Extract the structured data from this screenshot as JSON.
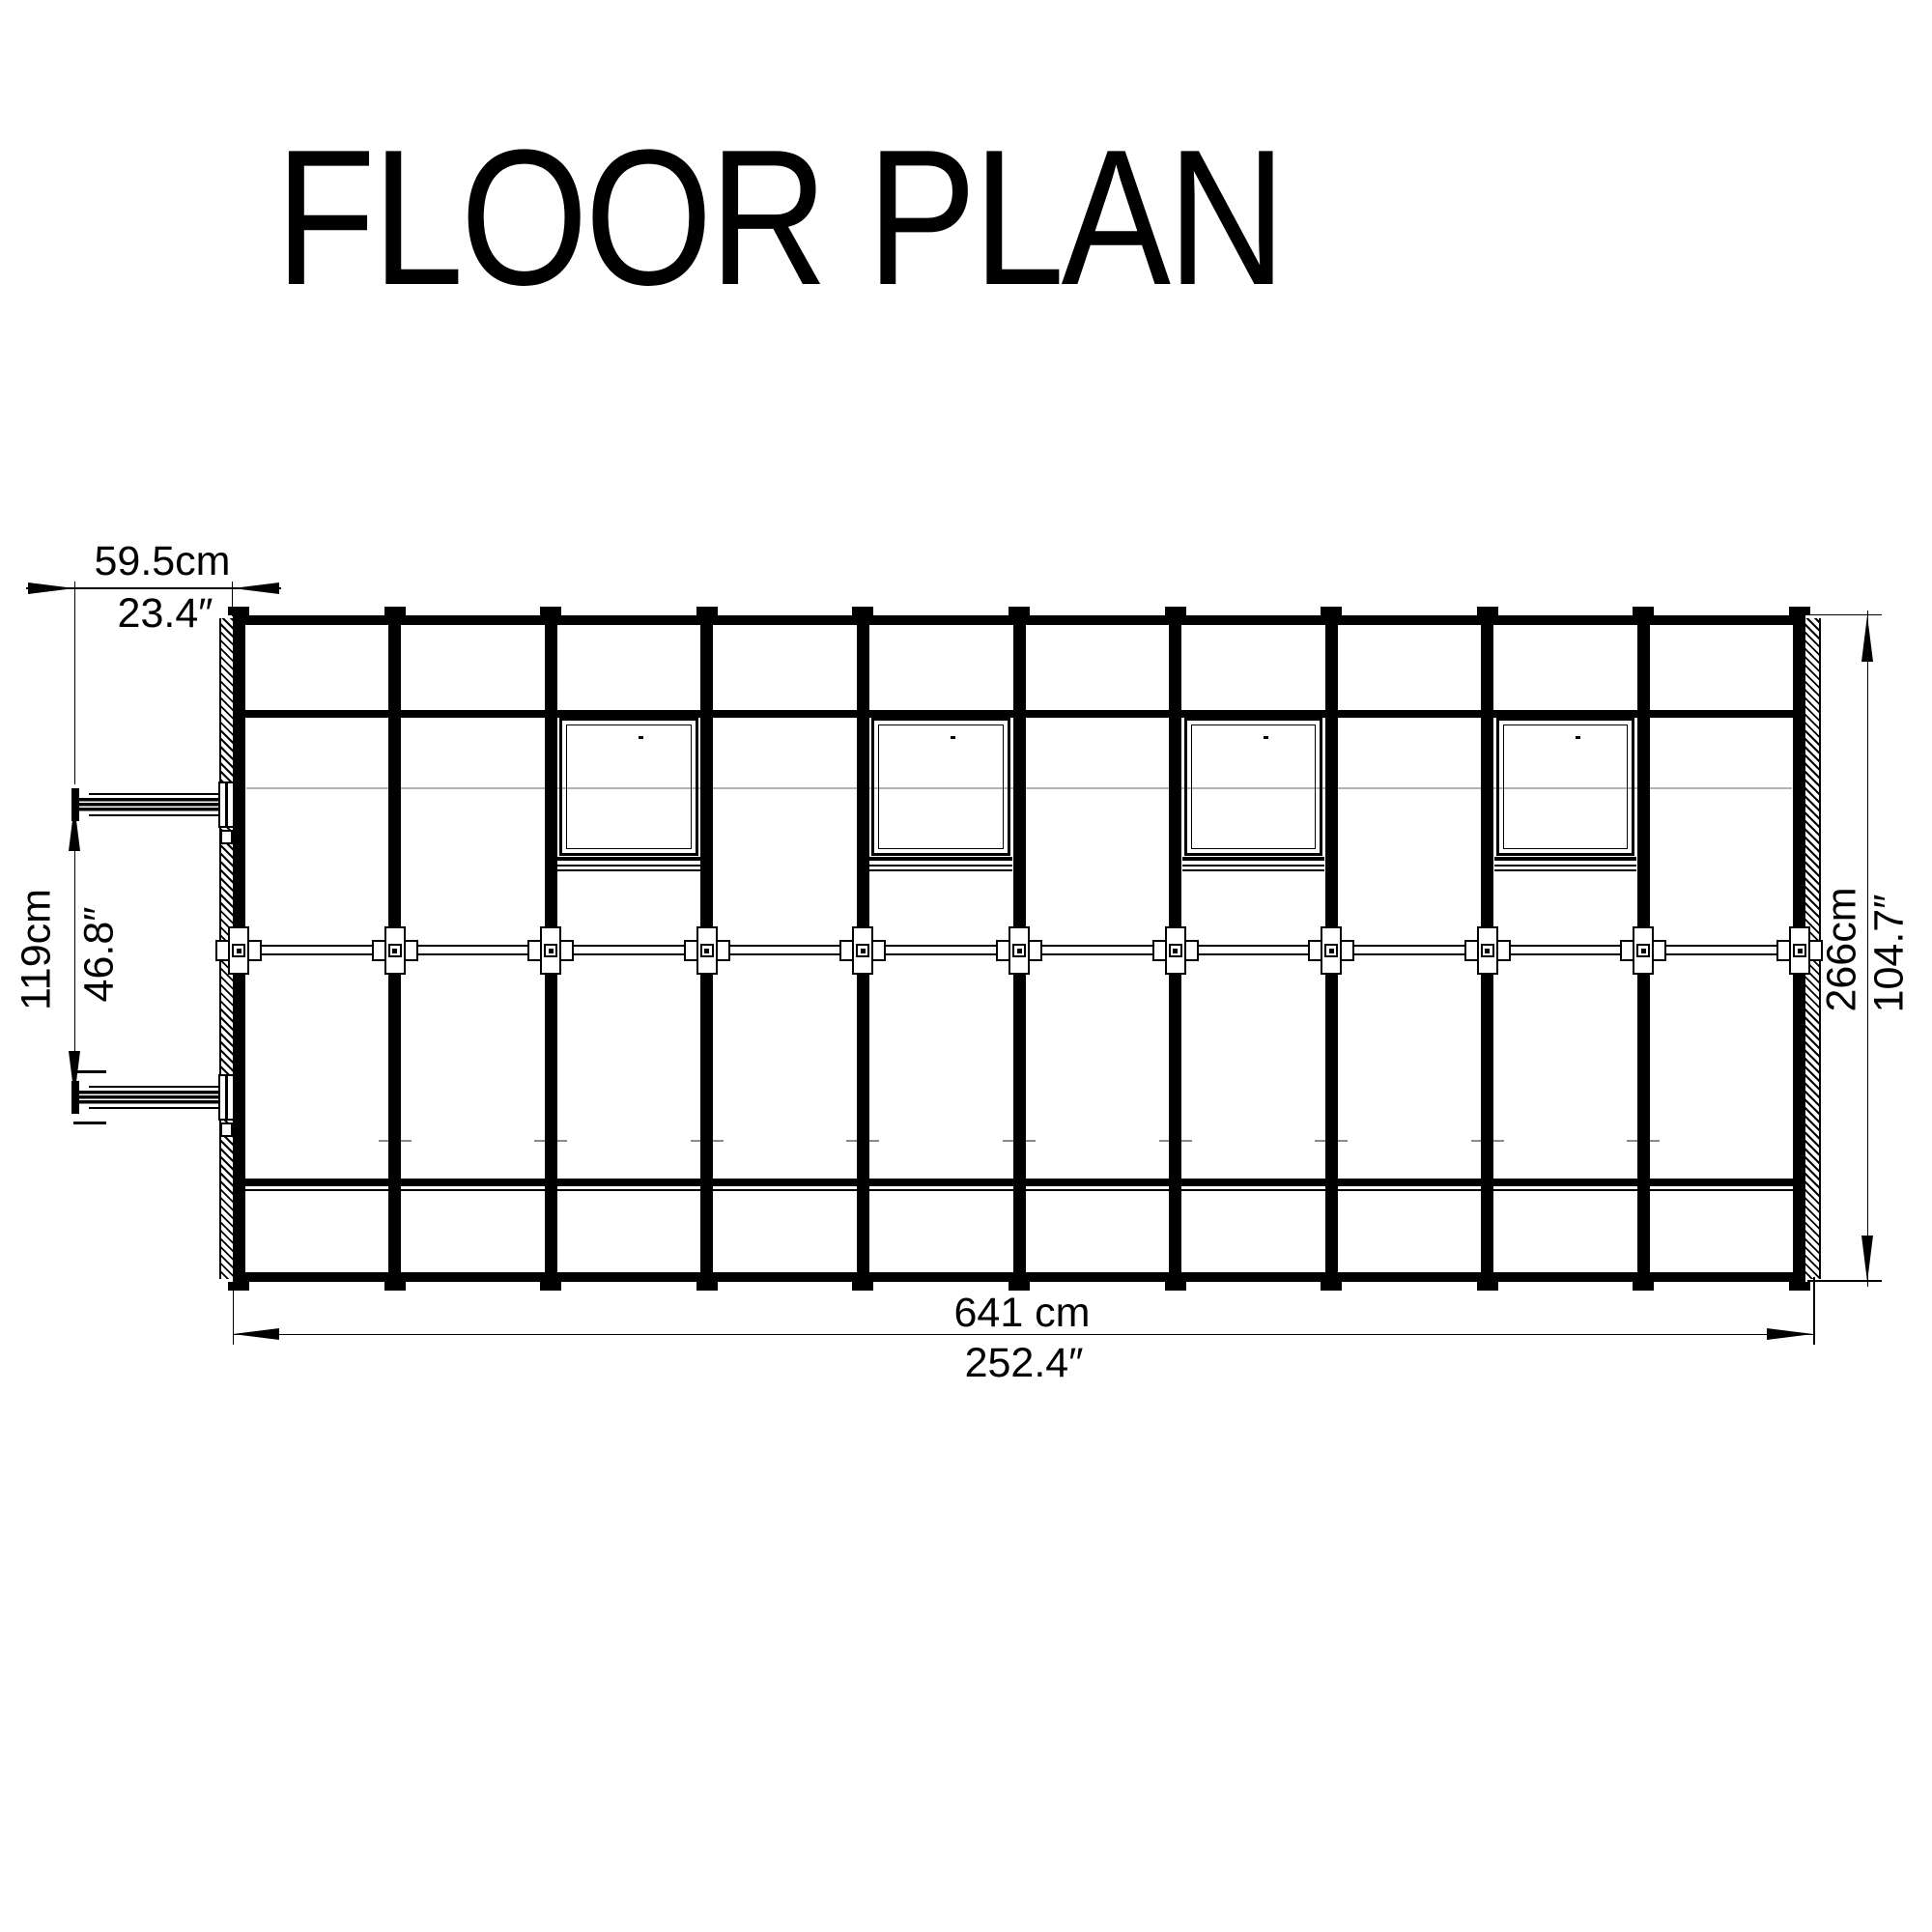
{
  "title": "FLOOR PLAN",
  "colors": {
    "ink": "#000000",
    "faint_line": "#b3b3b3"
  },
  "dimensions": {
    "arm_length": {
      "cm": "59.5cm",
      "inch": "23.4″"
    },
    "arm_spacing": {
      "cm": "119cm",
      "inch": "46.8″"
    },
    "depth": {
      "cm": "266cm",
      "inch": "104.7″"
    },
    "width": {
      "cm": "641 cm",
      "inch": "252.4″"
    }
  },
  "plan": {
    "bays": 10,
    "ribs": 11,
    "window_bays": [
      3,
      5,
      7,
      9
    ],
    "cross_connectors": 11,
    "opener_arms": 2
  }
}
